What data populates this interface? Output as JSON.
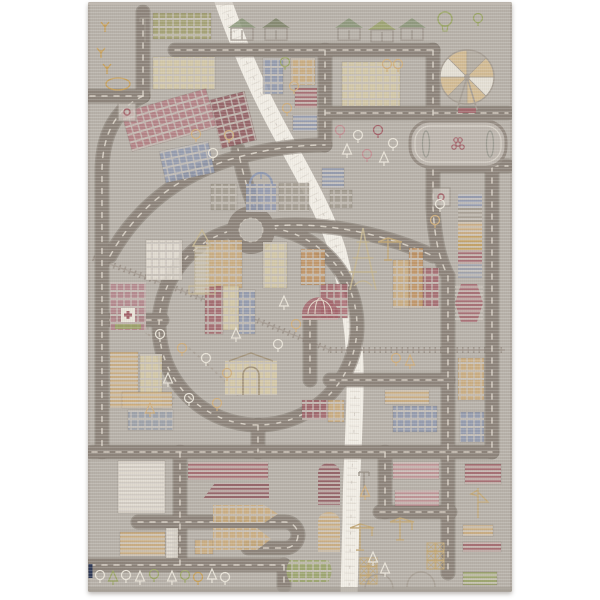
{
  "photo": {
    "subject": "play-rug-city-road-map",
    "page_bg": "#ffffff",
    "rug": {
      "x": 88,
      "y": 2,
      "w": 424,
      "h": 590,
      "bg": "#b7b1a9",
      "edge": "#aea79f",
      "tag_color": "#2f3a57"
    }
  },
  "palette": {
    "road": "#8d847b",
    "road_casing": "#7d746c",
    "road_dash": "#ddd5ca",
    "river": "#f2eee6",
    "river_mark": "#c9c2b9",
    "rail": "#968d84",
    "path": "#a89f94",
    "outline": "#9a9289",
    "olive": "#a3a06e",
    "cream": "#d9cda8",
    "tan": "#cfae7d",
    "orange": "#c4935f",
    "red": "#a4636a",
    "darkred": "#8f565c",
    "brick": "#b3797f",
    "pink": "#c18e92",
    "blue": "#8f99b1",
    "slate": "#9aa0ac",
    "gray": "#a29b8f",
    "white": "#e9e4d9",
    "green": "#9aa566",
    "yellow": "#c7a05a"
  },
  "scene": {
    "river": {
      "d": "M134,-4 C146,30 162,72 186,118 C208,160 236,205 250,250 C258,282 266,320 267,365 C268,415 263,465 263,515 L261,592",
      "width": 17
    },
    "railways": [
      {
        "d": "M5,256 Q115,295 242,348"
      },
      {
        "d": "M242,348 H417"
      }
    ],
    "park_paths": [
      {
        "d": "M60,332 Q96,362 84,402"
      },
      {
        "d": "M96,342 Q132,372 152,396"
      },
      {
        "d": "M36,300 Q66,316 58,332"
      }
    ],
    "roads": [
      {
        "d": "M2,94 H55"
      },
      {
        "d": "M55,94 V10"
      },
      {
        "d": "M87,48 H345"
      },
      {
        "d": "M55,94 C30,106 14,130 14,170 V450"
      },
      {
        "d": "M4,450 H404"
      },
      {
        "d": "M92,450 V563"
      },
      {
        "d": "M2,563 H196"
      },
      {
        "d": "M196,563 V584"
      },
      {
        "d": "M50,520 H197 A13,13 0 0 1 197,546 H160"
      },
      {
        "d": "M345,48 V205 Q347,250 360,274 V571"
      },
      {
        "d": "M237,111 H420"
      },
      {
        "d": "M404,164 V450"
      },
      {
        "d": "M345,164 H420"
      },
      {
        "d": "M237,48 V143"
      },
      {
        "d": "M22,254 Q60,185 140,158 Q190,143 237,143"
      },
      {
        "d": "M167,206 Q156,180 150,147"
      },
      {
        "d": "M185,224 C240,219 302,234 345,254"
      },
      {
        "d": "M22,318 H74"
      },
      {
        "d": "M170,423 V450"
      },
      {
        "d": "M242,378 H360"
      },
      {
        "d": "M222,318 V378"
      },
      {
        "d": "M297,450 V510"
      },
      {
        "d": "M292,510 H362"
      }
    ],
    "ring": {
      "cx": 170,
      "cy": 324,
      "r": 99
    },
    "roundabout": {
      "cx": 163,
      "cy": 228,
      "r": 24
    },
    "buildings": [
      [
        65,
        11,
        58,
        26,
        "olive",
        "grid"
      ],
      [
        65,
        55,
        62,
        32,
        "cream",
        "grid"
      ],
      [
        175,
        56,
        20,
        36,
        "blue",
        "grid"
      ],
      [
        203,
        56,
        24,
        27,
        "tan",
        "grid"
      ],
      [
        207,
        86,
        22,
        20,
        "red",
        "stripes"
      ],
      [
        205,
        113,
        24,
        16,
        "blue",
        "stripes"
      ],
      [
        254,
        60,
        58,
        44,
        "cream",
        "grid"
      ],
      [
        37,
        98,
        88,
        40,
        "brick",
        "grid",
        -16
      ],
      [
        127,
        93,
        36,
        50,
        "darkred",
        "grid",
        -14
      ],
      [
        74,
        144,
        50,
        32,
        "blue",
        "grid",
        -12
      ],
      [
        123,
        182,
        26,
        26,
        "gray",
        "grid"
      ],
      [
        191,
        181,
        30,
        28,
        "gray",
        "grid"
      ],
      [
        234,
        166,
        22,
        20,
        "blue",
        "stripes"
      ],
      [
        242,
        188,
        22,
        18,
        "gray",
        "grid"
      ],
      [
        118,
        238,
        36,
        48,
        "tan",
        "grid"
      ],
      [
        175,
        240,
        24,
        46,
        "cream",
        "grid"
      ],
      [
        117,
        284,
        18,
        48,
        "red",
        "grid"
      ],
      [
        135,
        284,
        16,
        44,
        "cream",
        "grid"
      ],
      [
        151,
        288,
        16,
        44,
        "blue",
        "grid"
      ],
      [
        232,
        282,
        28,
        34,
        "red",
        "grid"
      ],
      [
        58,
        238,
        36,
        40,
        "white",
        "grid"
      ],
      [
        22,
        350,
        28,
        56,
        "tan",
        "stripes"
      ],
      [
        52,
        352,
        22,
        54,
        "cream",
        "grid"
      ],
      [
        213,
        247,
        24,
        36,
        "orange",
        "grid"
      ],
      [
        305,
        258,
        16,
        48,
        "tan",
        "grid"
      ],
      [
        321,
        246,
        14,
        60,
        "orange",
        "grid"
      ],
      [
        335,
        266,
        16,
        40,
        "red",
        "grid"
      ],
      [
        370,
        356,
        26,
        42,
        "tan",
        "grid"
      ],
      [
        372,
        410,
        24,
        30,
        "blue",
        "grid"
      ],
      [
        297,
        388,
        44,
        14,
        "tan",
        "stripes"
      ],
      [
        305,
        404,
        44,
        26,
        "blue",
        "grid"
      ],
      [
        214,
        398,
        26,
        20,
        "red",
        "grid"
      ],
      [
        240,
        398,
        16,
        22,
        "tan",
        "grid"
      ],
      [
        34,
        390,
        50,
        16,
        "tan",
        "stripes"
      ],
      [
        40,
        408,
        45,
        20,
        "slate",
        "grid"
      ],
      [
        30,
        459,
        47,
        52,
        "white",
        "stripes"
      ],
      [
        100,
        460,
        80,
        18,
        "red",
        "stripes"
      ],
      [
        32,
        530,
        45,
        24,
        "tan",
        "stripes"
      ],
      [
        78,
        526,
        12,
        30,
        "white",
        "stripes"
      ],
      [
        107,
        538,
        18,
        14,
        "tan",
        "grid"
      ],
      [
        305,
        460,
        46,
        17,
        "pink",
        "stripes"
      ],
      [
        307,
        488,
        44,
        16,
        "pink",
        "stripes"
      ],
      [
        377,
        462,
        36,
        20,
        "red",
        "stripes"
      ],
      [
        375,
        523,
        30,
        11,
        "tan",
        "stripes"
      ],
      [
        375,
        540,
        38,
        10,
        "red",
        "stripes"
      ],
      [
        375,
        570,
        34,
        13,
        "green",
        "stripes"
      ]
    ],
    "houses": [
      {
        "x": 140,
        "y": 16,
        "roof": "#8a9678"
      },
      {
        "x": 174,
        "y": 16,
        "roof": "#7e8468"
      },
      {
        "x": 247,
        "y": 16,
        "roof": "#8a9678"
      },
      {
        "x": 280,
        "y": 18,
        "roof": "#9aa36b"
      },
      {
        "x": 310,
        "y": 16,
        "roof": "#8a9678"
      }
    ],
    "landmarks": [
      {
        "k": "ferris",
        "x": 379,
        "y": 75,
        "r": 27
      },
      {
        "k": "stadium",
        "x": 322,
        "y": 119,
        "w": 96,
        "h": 46
      },
      {
        "k": "church",
        "x": 158,
        "y": 170,
        "w": 30,
        "h": 40
      },
      {
        "k": "hospital",
        "x": 22,
        "y": 280,
        "w": 36,
        "h": 48
      },
      {
        "k": "belltower",
        "x": 99,
        "y": 228,
        "w": 30,
        "h": 64
      },
      {
        "k": "eiffel",
        "x": 260,
        "y": 226,
        "w": 30,
        "h": 62
      },
      {
        "k": "museum",
        "x": 137,
        "y": 353,
        "w": 52,
        "h": 40
      },
      {
        "k": "dome",
        "x": 214,
        "y": 286,
        "w": 36,
        "h": 32
      },
      {
        "k": "stack",
        "x": 370,
        "y": 192,
        "w": 24,
        "h": 84
      },
      {
        "k": "hex",
        "x": 367,
        "y": 282,
        "w": 28,
        "h": 38
      },
      {
        "k": "crane",
        "x": 300,
        "y": 232,
        "s": 26
      },
      {
        "k": "crane",
        "x": 272,
        "y": 518,
        "s": 30
      },
      {
        "k": "crane",
        "x": 312,
        "y": 512,
        "s": 26
      },
      {
        "k": "boat",
        "x": 125,
        "y": 503,
        "w": 65,
        "h": 18
      },
      {
        "k": "boat",
        "x": 125,
        "y": 526,
        "w": 58,
        "h": 22
      },
      {
        "k": "wedge",
        "x": 115,
        "y": 481,
        "w": 66,
        "h": 16
      },
      {
        "k": "vboat",
        "x": 230,
        "y": 461,
        "w": 22,
        "h": 42,
        "c": "darkred"
      },
      {
        "k": "vboat",
        "x": 230,
        "y": 510,
        "w": 22,
        "h": 40,
        "c": "tan"
      },
      {
        "k": "gboat",
        "x": 202,
        "y": 558,
        "w": 38,
        "h": 22
      },
      {
        "k": "balloon",
        "x": 357,
        "y": 10
      },
      {
        "k": "sign",
        "x": 30,
        "y": 101
      },
      {
        "k": "sign",
        "x": 344,
        "y": 186
      },
      {
        "k": "crates",
        "x": 339,
        "y": 541
      },
      {
        "k": "crates",
        "x": 272,
        "y": 556
      },
      {
        "k": "hangar",
        "x": 277,
        "y": 572
      },
      {
        "k": "hangar",
        "x": 319,
        "y": 570
      },
      {
        "k": "sailboat",
        "x": 390,
        "y": 486
      },
      {
        "k": "lamp",
        "x": 57,
        "y": 12
      },
      {
        "k": "lamp",
        "x": 276,
        "y": 466
      }
    ],
    "trees": [
      [
        17,
        22,
        "s",
        "yellow"
      ],
      [
        13,
        48,
        "s",
        "yellow"
      ],
      [
        19,
        64,
        "s",
        "yellow"
      ],
      [
        22,
        82,
        "o",
        "yellow"
      ],
      [
        197,
        60,
        "r",
        "green"
      ],
      [
        206,
        84,
        "r",
        "tan"
      ],
      [
        199,
        106,
        "r",
        "tan"
      ],
      [
        299,
        62,
        "r",
        "tan"
      ],
      [
        310,
        62,
        "r",
        "tan"
      ],
      [
        108,
        132,
        "r",
        "tan"
      ],
      [
        125,
        151,
        "r",
        "white"
      ],
      [
        141,
        133,
        "r",
        "tan"
      ],
      [
        252,
        128,
        "r",
        "pink"
      ],
      [
        270,
        133,
        "r",
        "white"
      ],
      [
        290,
        128,
        "r",
        "red"
      ],
      [
        305,
        141,
        "r",
        "white"
      ],
      [
        259,
        148,
        "p",
        "white"
      ],
      [
        279,
        152,
        "r",
        "pink"
      ],
      [
        296,
        156,
        "p",
        "white"
      ],
      [
        352,
        202,
        "r",
        "white"
      ],
      [
        347,
        218,
        "r",
        "tan"
      ],
      [
        72,
        332,
        "r",
        "white"
      ],
      [
        94,
        346,
        "r",
        "tan"
      ],
      [
        118,
        356,
        "r",
        "white"
      ],
      [
        139,
        371,
        "r",
        "tan"
      ],
      [
        80,
        377,
        "p",
        "white"
      ],
      [
        101,
        396,
        "r",
        "white"
      ],
      [
        129,
        401,
        "r",
        "tan"
      ],
      [
        62,
        407,
        "p",
        "tan"
      ],
      [
        148,
        332,
        "p",
        "white"
      ],
      [
        196,
        300,
        "p",
        "white"
      ],
      [
        208,
        322,
        "r",
        "tan"
      ],
      [
        190,
        342,
        "r",
        "white"
      ],
      [
        308,
        356,
        "r",
        "tan"
      ],
      [
        322,
        359,
        "p",
        "tan"
      ],
      [
        12,
        573,
        "r",
        "white"
      ],
      [
        25,
        575,
        "p",
        "green"
      ],
      [
        38,
        573,
        "r",
        "white"
      ],
      [
        52,
        575,
        "p",
        "white"
      ],
      [
        66,
        572,
        "r",
        "green"
      ],
      [
        84,
        575,
        "p",
        "white"
      ],
      [
        97,
        573,
        "r",
        "green"
      ],
      [
        110,
        575,
        "r",
        "yellow"
      ],
      [
        124,
        573,
        "p",
        "white"
      ],
      [
        137,
        575,
        "r",
        "white"
      ],
      [
        285,
        556,
        "p",
        "white"
      ],
      [
        297,
        567,
        "p",
        "white"
      ],
      [
        277,
        490,
        "p",
        "tan"
      ],
      [
        390,
        16,
        "r",
        "green"
      ]
    ]
  }
}
